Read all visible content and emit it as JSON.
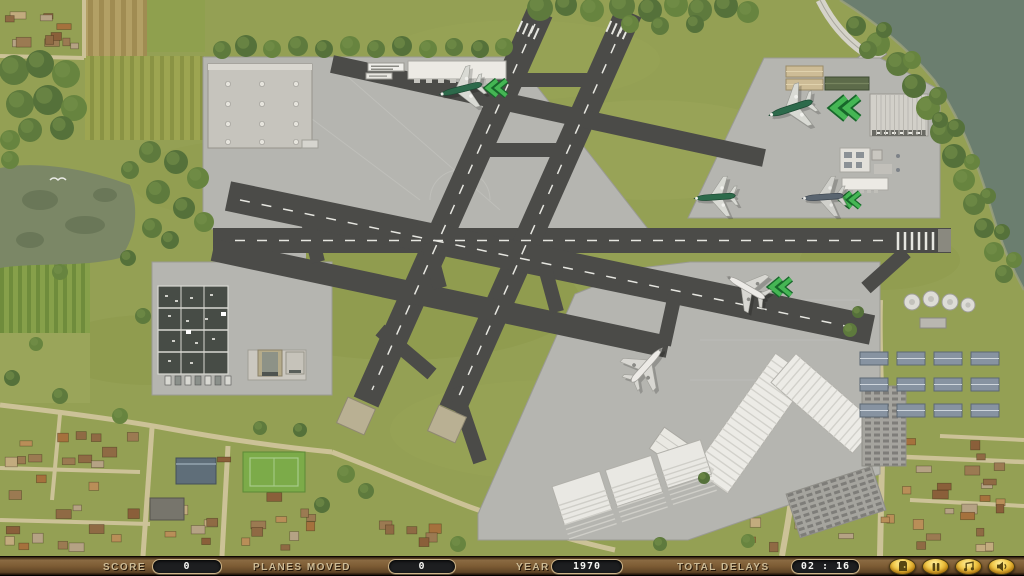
{
  "hud": {
    "score_label": "SCORE",
    "score_value": "0",
    "planes_moved_label": "PLANES MOVED",
    "planes_moved_value": "0",
    "year_label": "YEAR",
    "year_value": "1970",
    "total_delays_label": "TOTAL DELAYS",
    "total_delays_value": "02 : 16",
    "buttons": [
      {
        "name": "quit-button",
        "icon": "door-icon"
      },
      {
        "name": "pause-button",
        "icon": "pause-icon"
      },
      {
        "name": "music-button",
        "icon": "music-note-icon"
      },
      {
        "name": "sound-button",
        "icon": "speaker-icon"
      }
    ]
  },
  "colors": {
    "grass": "#94a054",
    "apron": "#b5b5b0",
    "runway": "#4b4b48",
    "water": "#6b7e6f",
    "chevron_green": "#45b654",
    "plane_green": "#2d6a4b",
    "plane_white": "#eceae6",
    "plane_dark": "#5a6570",
    "hud_wood": "#7d5c34"
  },
  "planes": [
    {
      "id": "plane-parked-north-apron",
      "x": 462,
      "y": 89,
      "heading": 256,
      "color": "green",
      "scale": 1.0
    },
    {
      "id": "plane-parked-northeast-apron",
      "x": 792,
      "y": 108,
      "heading": 252,
      "color": "green",
      "scale": 1.05
    },
    {
      "id": "plane-taxiing-east-green",
      "x": 716,
      "y": 197,
      "heading": 266,
      "color": "green",
      "scale": 0.95
    },
    {
      "id": "plane-taxiing-east-dark",
      "x": 824,
      "y": 197,
      "heading": 266,
      "color": "dark",
      "scale": 0.95
    },
    {
      "id": "plane-taxiing-center-apron",
      "x": 747,
      "y": 288,
      "heading": 300,
      "color": "white",
      "scale": 1.0
    },
    {
      "id": "plane-taxiing-south-apron",
      "x": 646,
      "y": 366,
      "heading": 42,
      "color": "white",
      "scale": 1.05
    }
  ],
  "chevrons": [
    {
      "x": 497,
      "y": 88,
      "scale": 0.85
    },
    {
      "x": 846,
      "y": 108,
      "scale": 1.15
    },
    {
      "x": 851,
      "y": 200,
      "scale": 0.8
    },
    {
      "x": 781,
      "y": 287,
      "scale": 0.9
    }
  ]
}
